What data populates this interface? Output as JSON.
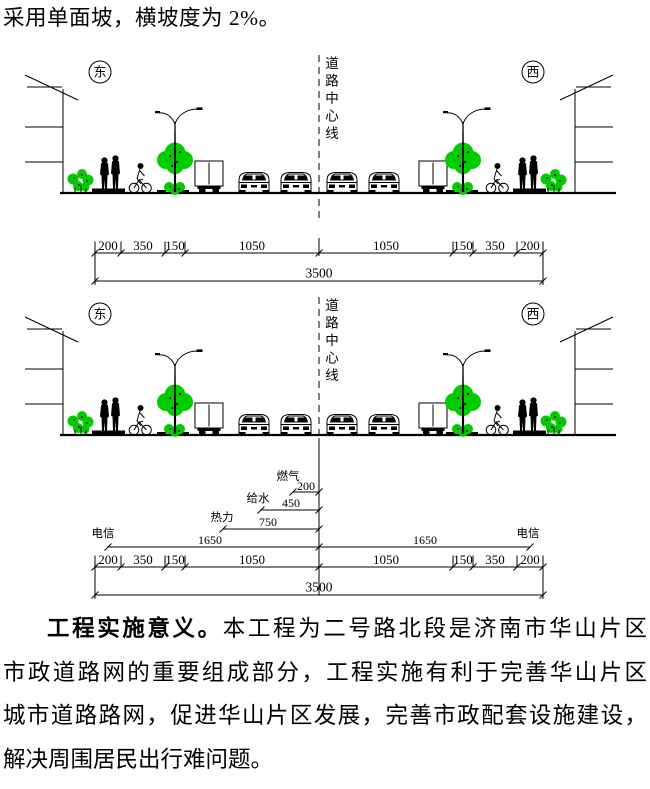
{
  "intro": {
    "text": "采用单面坡，横坡度为 2%。"
  },
  "figure": {
    "east": "东",
    "west": "西",
    "centerline_chars": [
      "道",
      "路",
      "中",
      "心",
      "线"
    ],
    "dims": {
      "segments": [
        "200",
        "350",
        "150",
        "1050",
        "1050",
        "150",
        "350",
        "200"
      ],
      "total": "3500"
    },
    "utilities": {
      "gas_label": "燃气",
      "gas_value": "200",
      "water_label": "给水",
      "water_value": "450",
      "heat_label": "热力",
      "heat_value": "750",
      "telecom_left_label": "电信",
      "telecom_left_value": "1650",
      "telecom_right_label": "电信",
      "telecom_right_value": "1650"
    },
    "colors": {
      "line": "#000000",
      "foliage": "#00cc00"
    }
  },
  "paragraph": {
    "line1_bold": "工程实施意义。",
    "line1_rest": "本工程为二号路北段是济南市华山片区",
    "line2": "市政道路网的重要组成部分，工程实施有利于完善华山片区",
    "line3": "城市道路路网，促进华山片区发展，完善市政配套设施建设，",
    "line4": "解决周围居民出行难问题。"
  }
}
